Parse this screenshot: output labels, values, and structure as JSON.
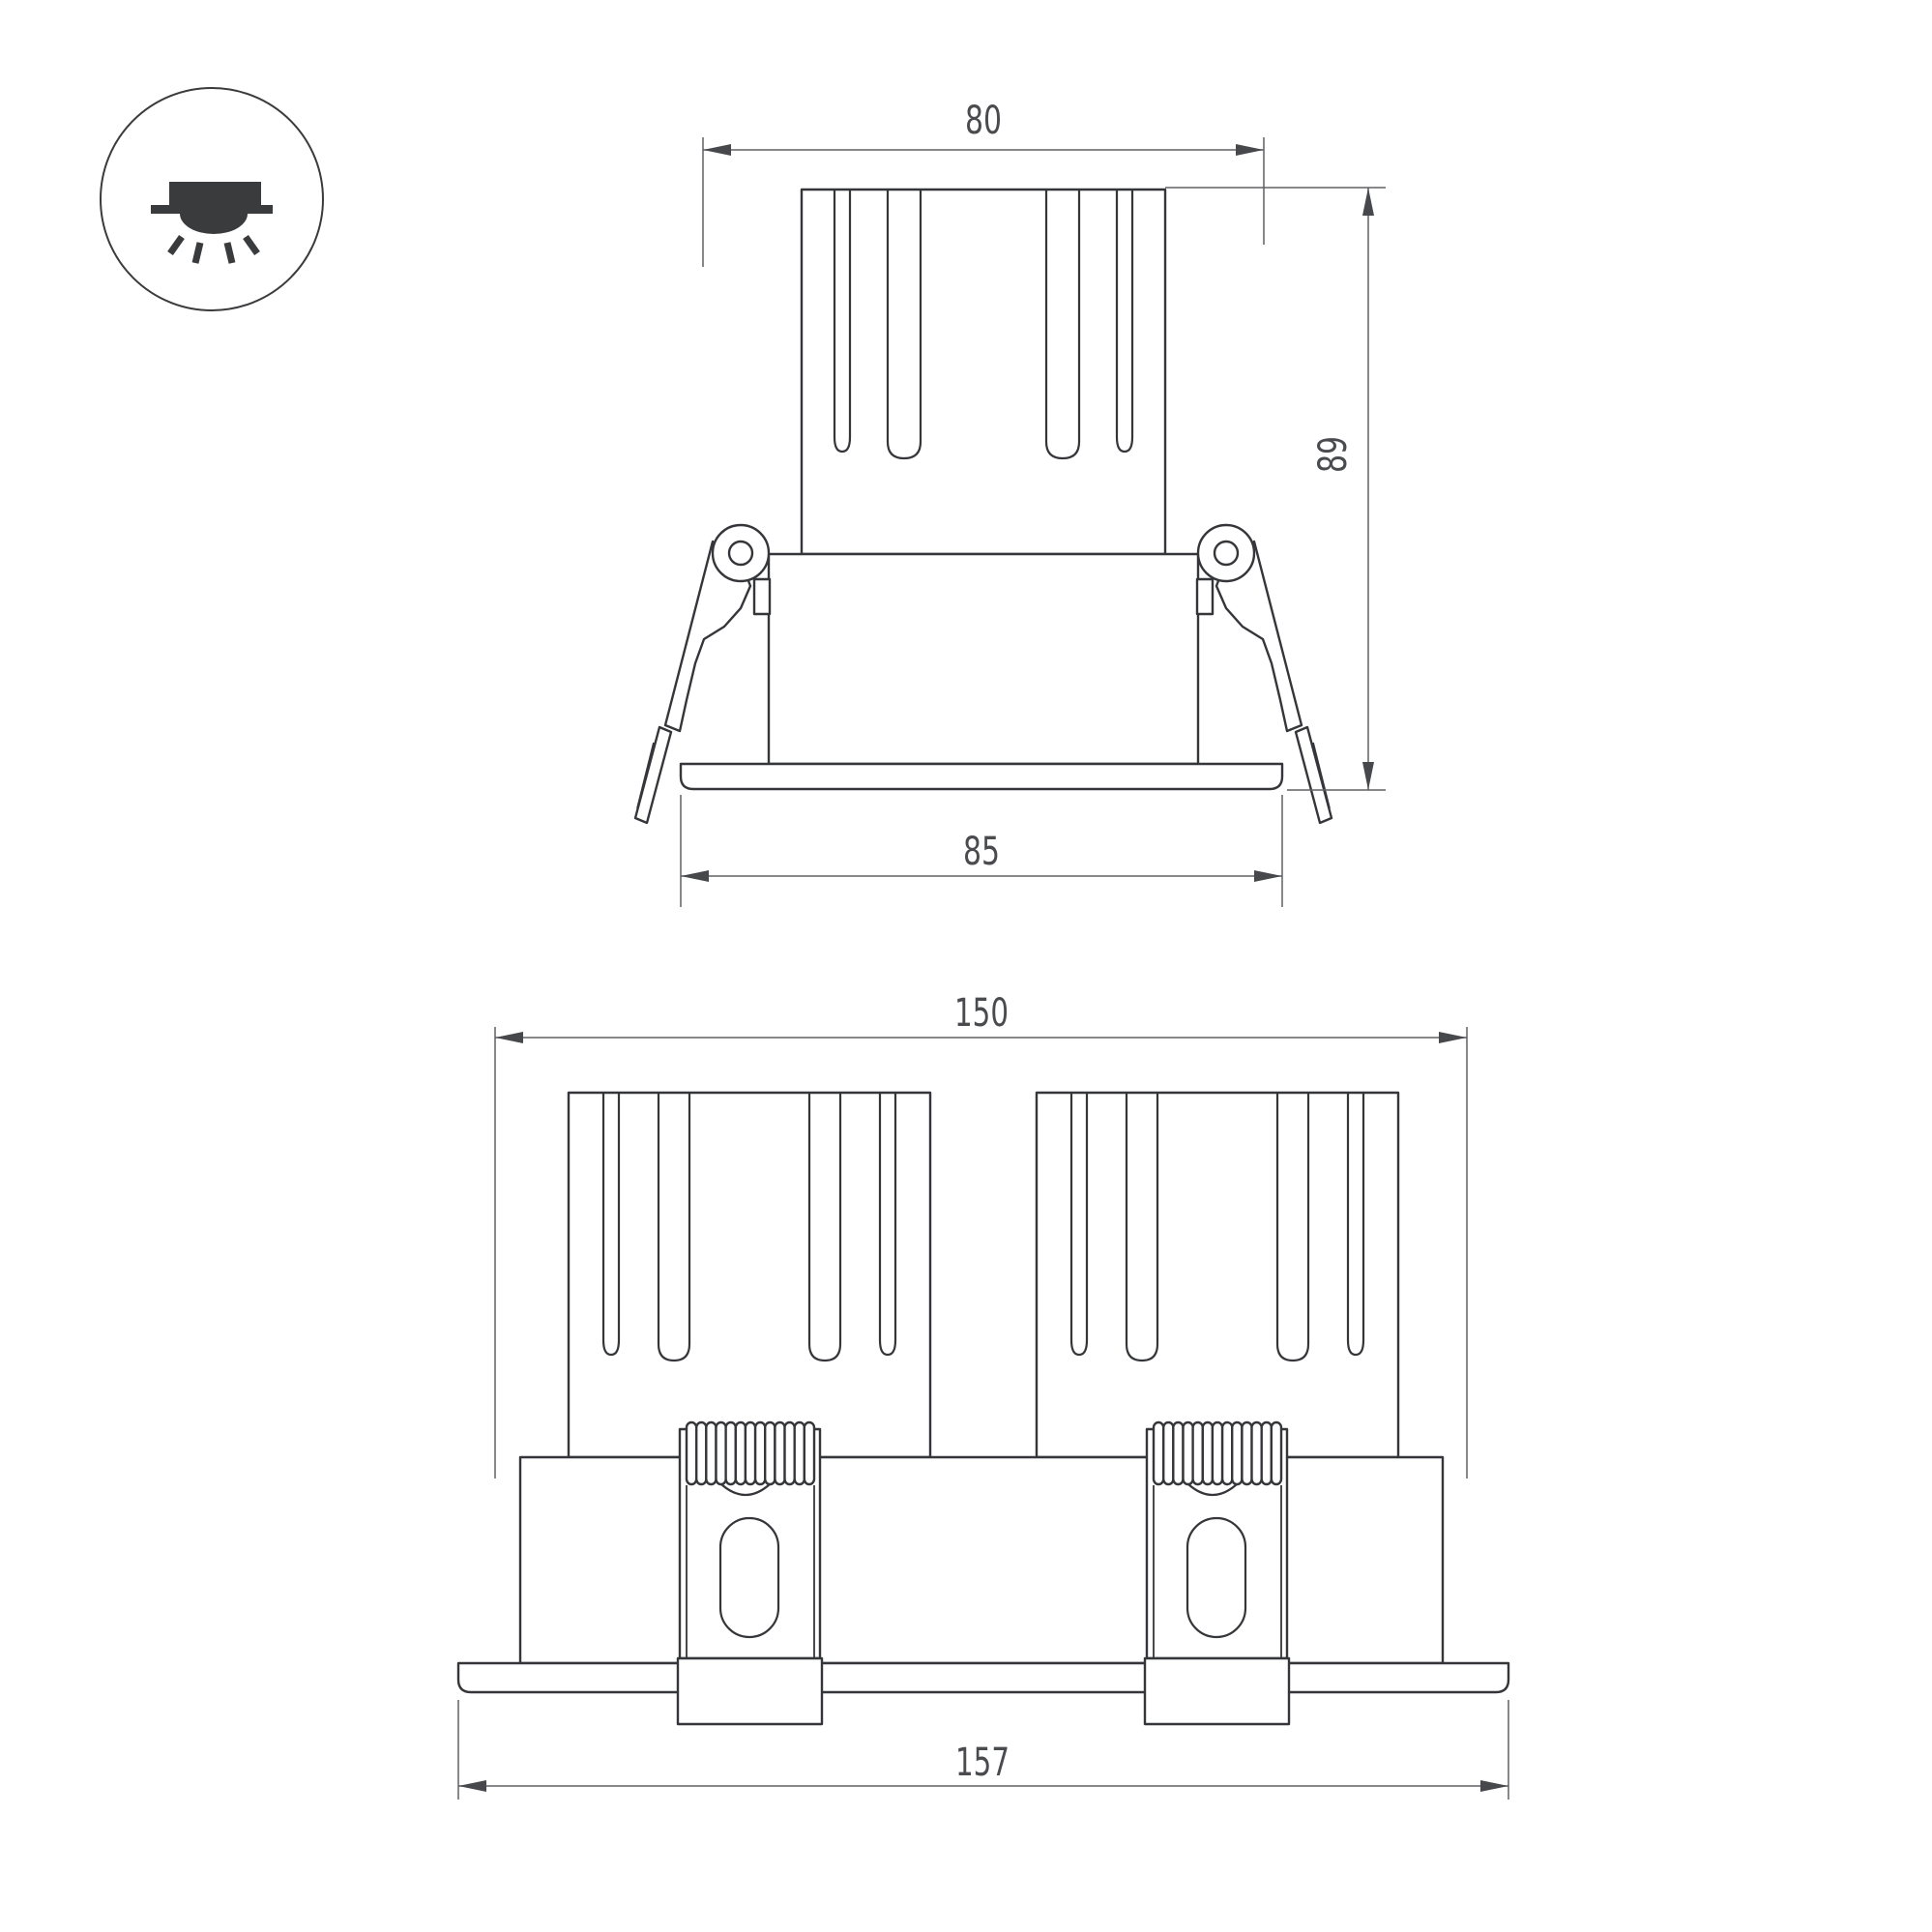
{
  "icon": {
    "name": "recessed-downlight-icon"
  },
  "views": {
    "single": {
      "dims": {
        "top_width": "80",
        "height": "89",
        "flange_width": "85"
      }
    },
    "double": {
      "dims": {
        "top_width": "150",
        "flange_width": "157"
      }
    }
  },
  "colors": {
    "background": "#ffffff",
    "outline": "#35363a",
    "dimension_line": "#606165",
    "text": "#4a4b4e",
    "icon": "#3a3b3d"
  }
}
